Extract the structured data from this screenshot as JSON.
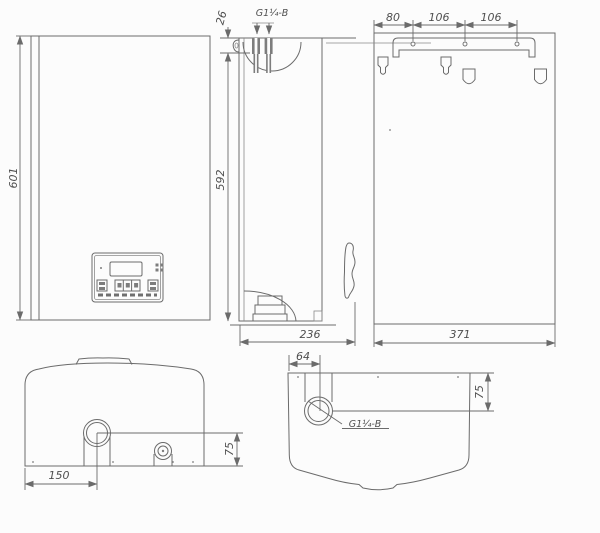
{
  "colors": {
    "line": "#6b6b6b",
    "text": "#4f4f4f",
    "dark_fill": "#7d7d7d",
    "background": "#fcfcfc"
  },
  "front_view": {
    "height_dim": "601"
  },
  "side_view": {
    "top_offset_dim": "26",
    "connection_label": "G1¼-B",
    "height_dim": "592",
    "depth_dim": "236"
  },
  "rear_view": {
    "bracket_spacing_dims": [
      "80",
      "106",
      "106"
    ],
    "width_dim": "371"
  },
  "bottom_view": {
    "connection_offset_dim": "150",
    "connection_depth_dim": "75"
  },
  "top_view": {
    "connection_offset_dim": "64",
    "connection_depth_dim": "75",
    "connection_label": "G1¼-B"
  }
}
